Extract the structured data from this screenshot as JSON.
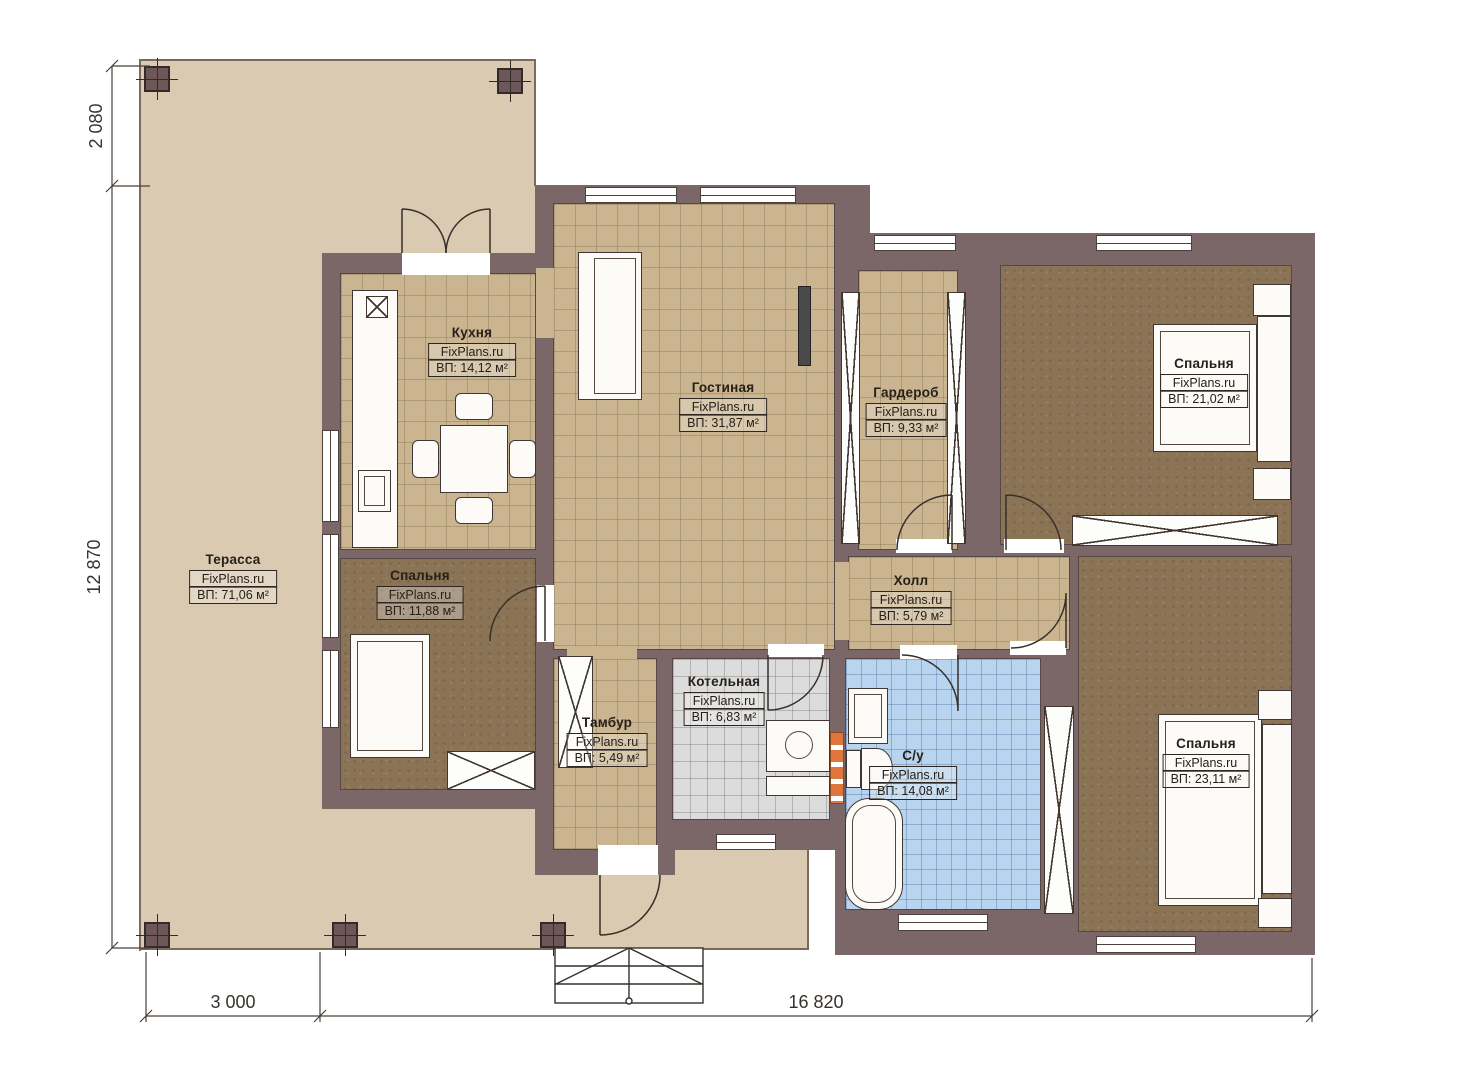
{
  "branding": {
    "watermark": "FixPlans.ru"
  },
  "rooms": [
    {
      "id": "terrace",
      "name": "Терасса",
      "watermark": "FixPlans.ru",
      "area": "ВП: 71,06 м²"
    },
    {
      "id": "kitchen",
      "name": "Кухня",
      "watermark": "FixPlans.ru",
      "area": "ВП: 14,12 м²"
    },
    {
      "id": "living-room",
      "name": "Гостиная",
      "watermark": "FixPlans.ru",
      "area": "ВП: 31,87 м²"
    },
    {
      "id": "wardrobe",
      "name": "Гардероб",
      "watermark": "FixPlans.ru",
      "area": "ВП: 9,33 м²"
    },
    {
      "id": "bedroom-top",
      "name": "Спальня",
      "watermark": "FixPlans.ru",
      "area": "ВП: 21,02 м²"
    },
    {
      "id": "bedroom-left",
      "name": "Спальня",
      "watermark": "FixPlans.ru",
      "area": "ВП: 11,88 м²"
    },
    {
      "id": "hall",
      "name": "Холл",
      "watermark": "FixPlans.ru",
      "area": "ВП: 5,79 м²"
    },
    {
      "id": "vestibule",
      "name": "Тамбур",
      "watermark": "FixPlans.ru",
      "area": "ВП: 5,49 м²"
    },
    {
      "id": "boiler-room",
      "name": "Котельная",
      "watermark": "FixPlans.ru",
      "area": "ВП: 6,83 м²"
    },
    {
      "id": "bathroom",
      "name": "С/у",
      "watermark": "FixPlans.ru",
      "area": "ВП: 14,08 м²"
    },
    {
      "id": "bedroom-bottom",
      "name": "Спальня",
      "watermark": "FixPlans.ru",
      "area": "ВП: 23,11 м²"
    }
  ],
  "dimensions": {
    "left_top": "2 080",
    "left_main": "12 870",
    "bottom_terrace": "3 000",
    "bottom_house": "16 820"
  },
  "colors": {
    "wall": "#7c6768",
    "terrace_floor": "#d9cab1",
    "tile_floor": "#cbb590",
    "bedroom_floor": "#8b7356",
    "boiler_floor": "#dcdcdc",
    "bathroom_floor": "#b9d4ef",
    "radiator_accent": "#e0763c"
  }
}
